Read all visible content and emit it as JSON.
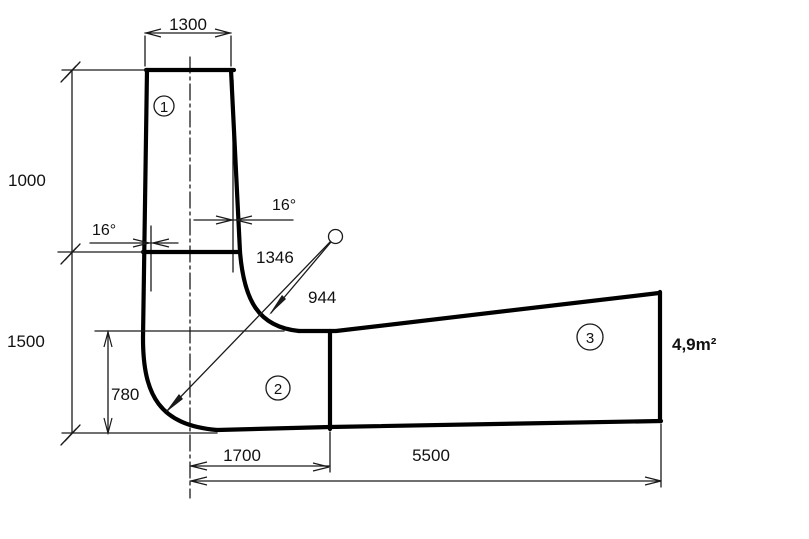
{
  "drawing": {
    "balloons": {
      "s1": "1",
      "s2": "2",
      "s3": "3"
    },
    "dims": {
      "top_width": "1300",
      "upper_height": "1000",
      "lower_height": "1500",
      "inner_height": "780",
      "bottom_near": "1700",
      "bottom_far": "5500",
      "radius_outer": "1346",
      "radius_inner": "944",
      "taper_angle_left": "16°",
      "taper_angle_right": "16°",
      "outlet_area": "4,9m²"
    },
    "colors": {
      "line": "#000000",
      "background": "#ffffff"
    }
  }
}
